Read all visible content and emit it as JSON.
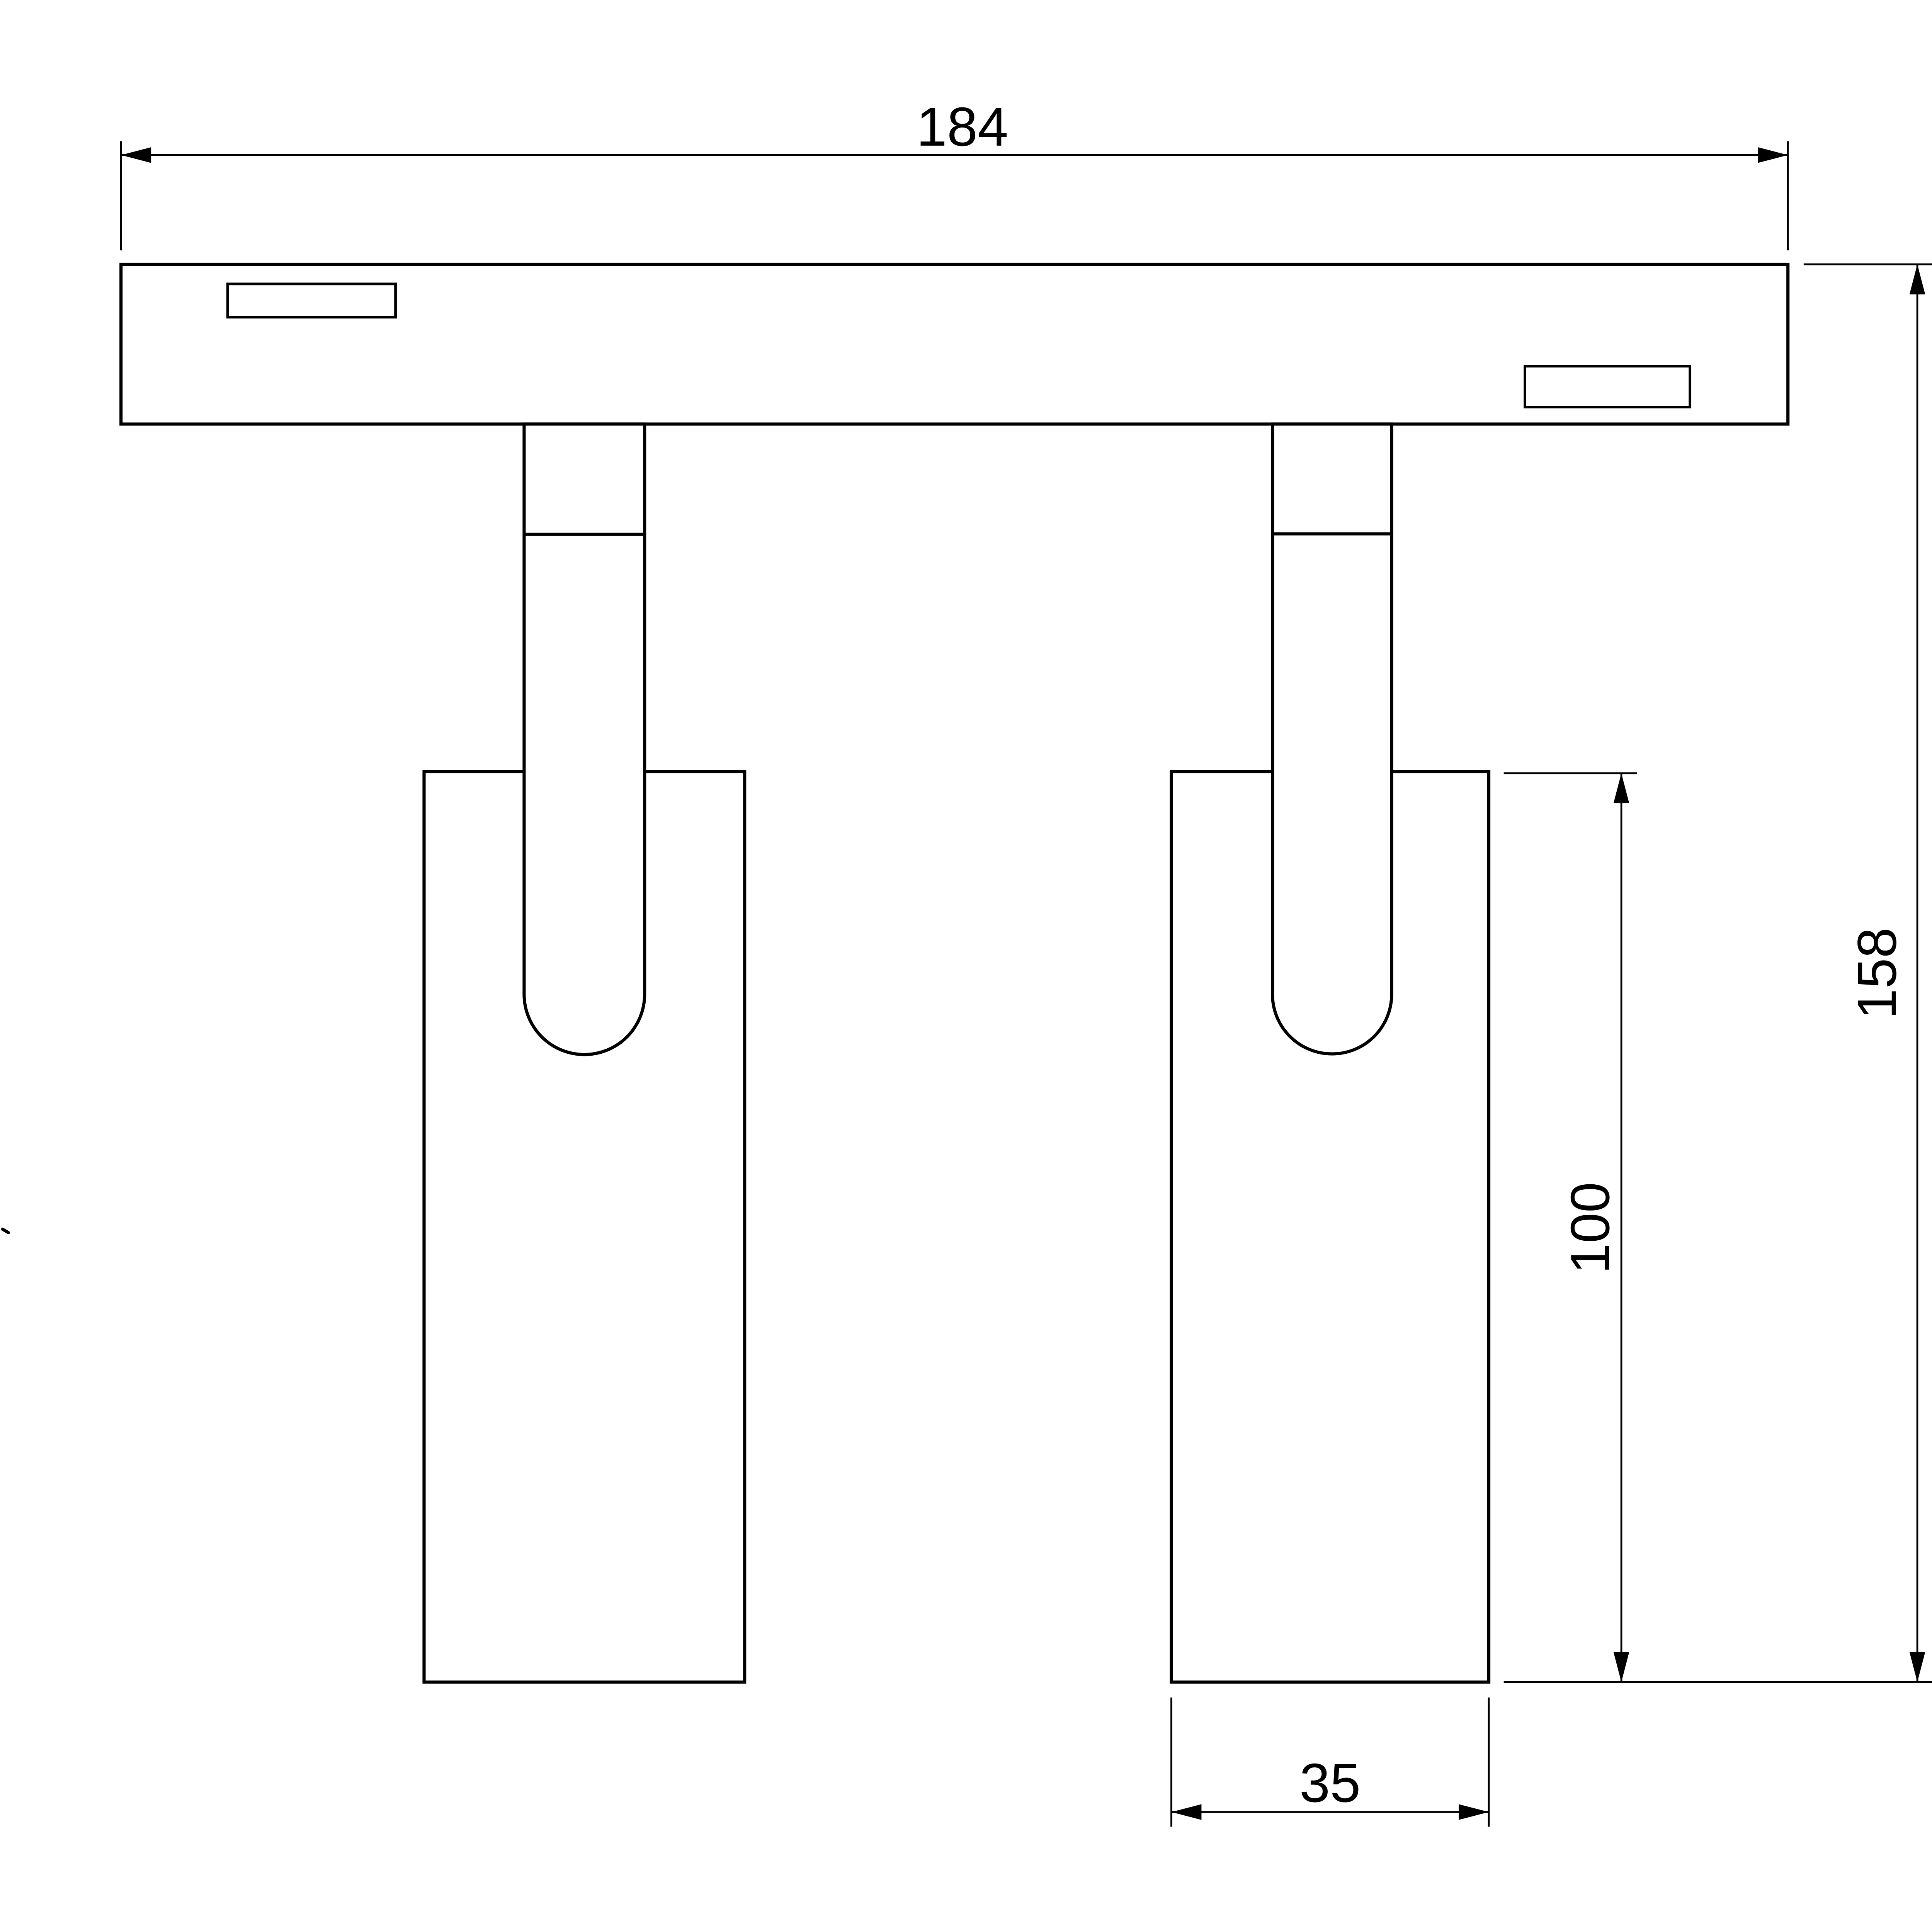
{
  "page": {
    "background_color": "#ffffff",
    "line_color": "#000000"
  },
  "drawing": {
    "kind": "technical-dimension-drawing",
    "subject": "two-head-track-spotlight-front-view"
  },
  "dimensions": {
    "track_width": {
      "label": "184",
      "orientation": "horizontal"
    },
    "overall_height": {
      "label": "158",
      "orientation": "vertical"
    },
    "head_length": {
      "label": "100",
      "orientation": "vertical"
    },
    "head_width": {
      "label": "35",
      "orientation": "horizontal"
    }
  }
}
